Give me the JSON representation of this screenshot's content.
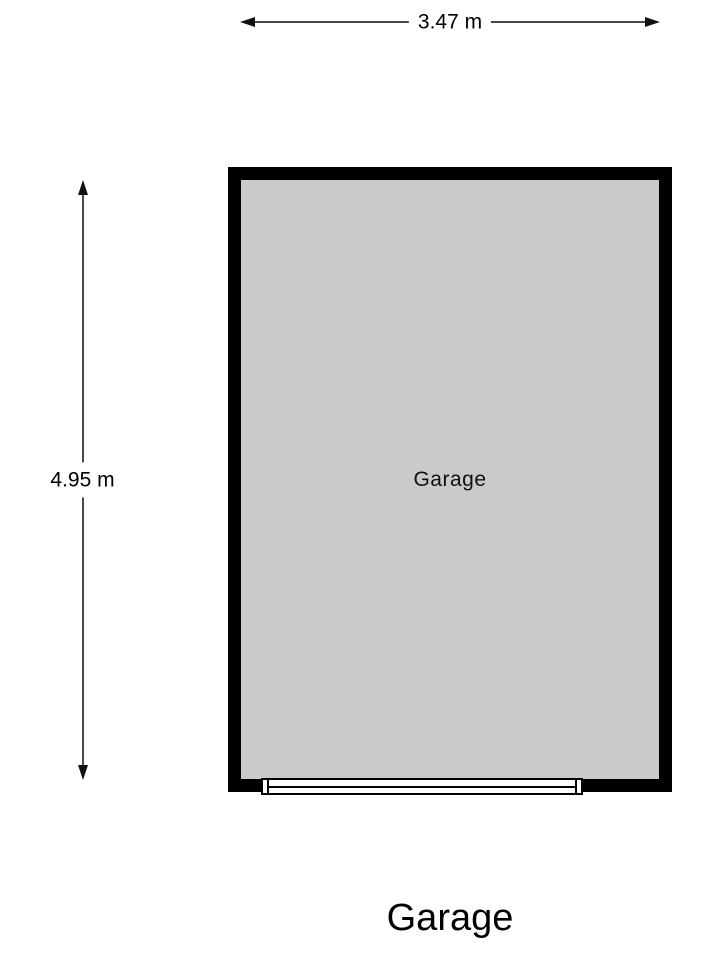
{
  "dimensions": {
    "width": {
      "label": "3.47 m"
    },
    "height": {
      "label": "4.95 m"
    }
  },
  "room": {
    "label": "Garage"
  },
  "title": "Garage",
  "colors": {
    "wall": "#000000",
    "floor": "#cacaca",
    "dimension_line": "#474747",
    "arrow": "#111111",
    "text": "#000000",
    "background": "#ffffff"
  }
}
